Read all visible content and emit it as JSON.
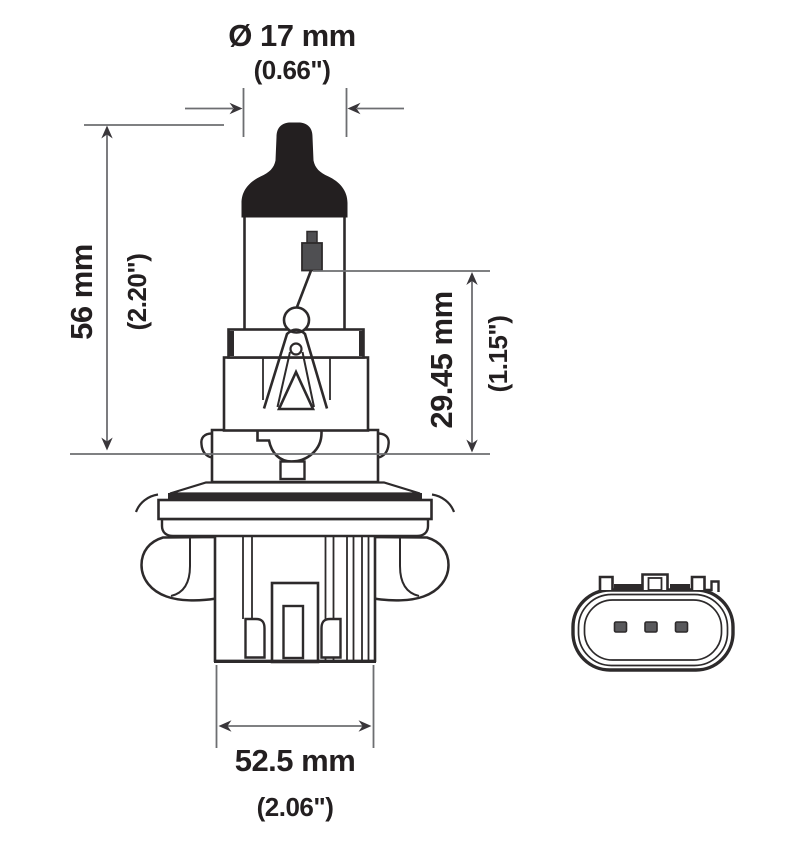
{
  "diagram": {
    "dim_diameter": {
      "metric": "Ø 17 mm",
      "imperial": "(0.66\")"
    },
    "dim_length": {
      "metric": "56 mm",
      "imperial": "(2.20\")"
    },
    "dim_filament": {
      "metric": "29.45 mm",
      "imperial": "(1.15\")"
    },
    "dim_base": {
      "metric": "52.5 mm",
      "imperial": "(2.06\")"
    },
    "colors": {
      "outline": "#2d2a2b",
      "dimension_line": "#6d6e71",
      "text": "#231f20",
      "black_fill": "#231f20",
      "background": "#ffffff"
    }
  }
}
